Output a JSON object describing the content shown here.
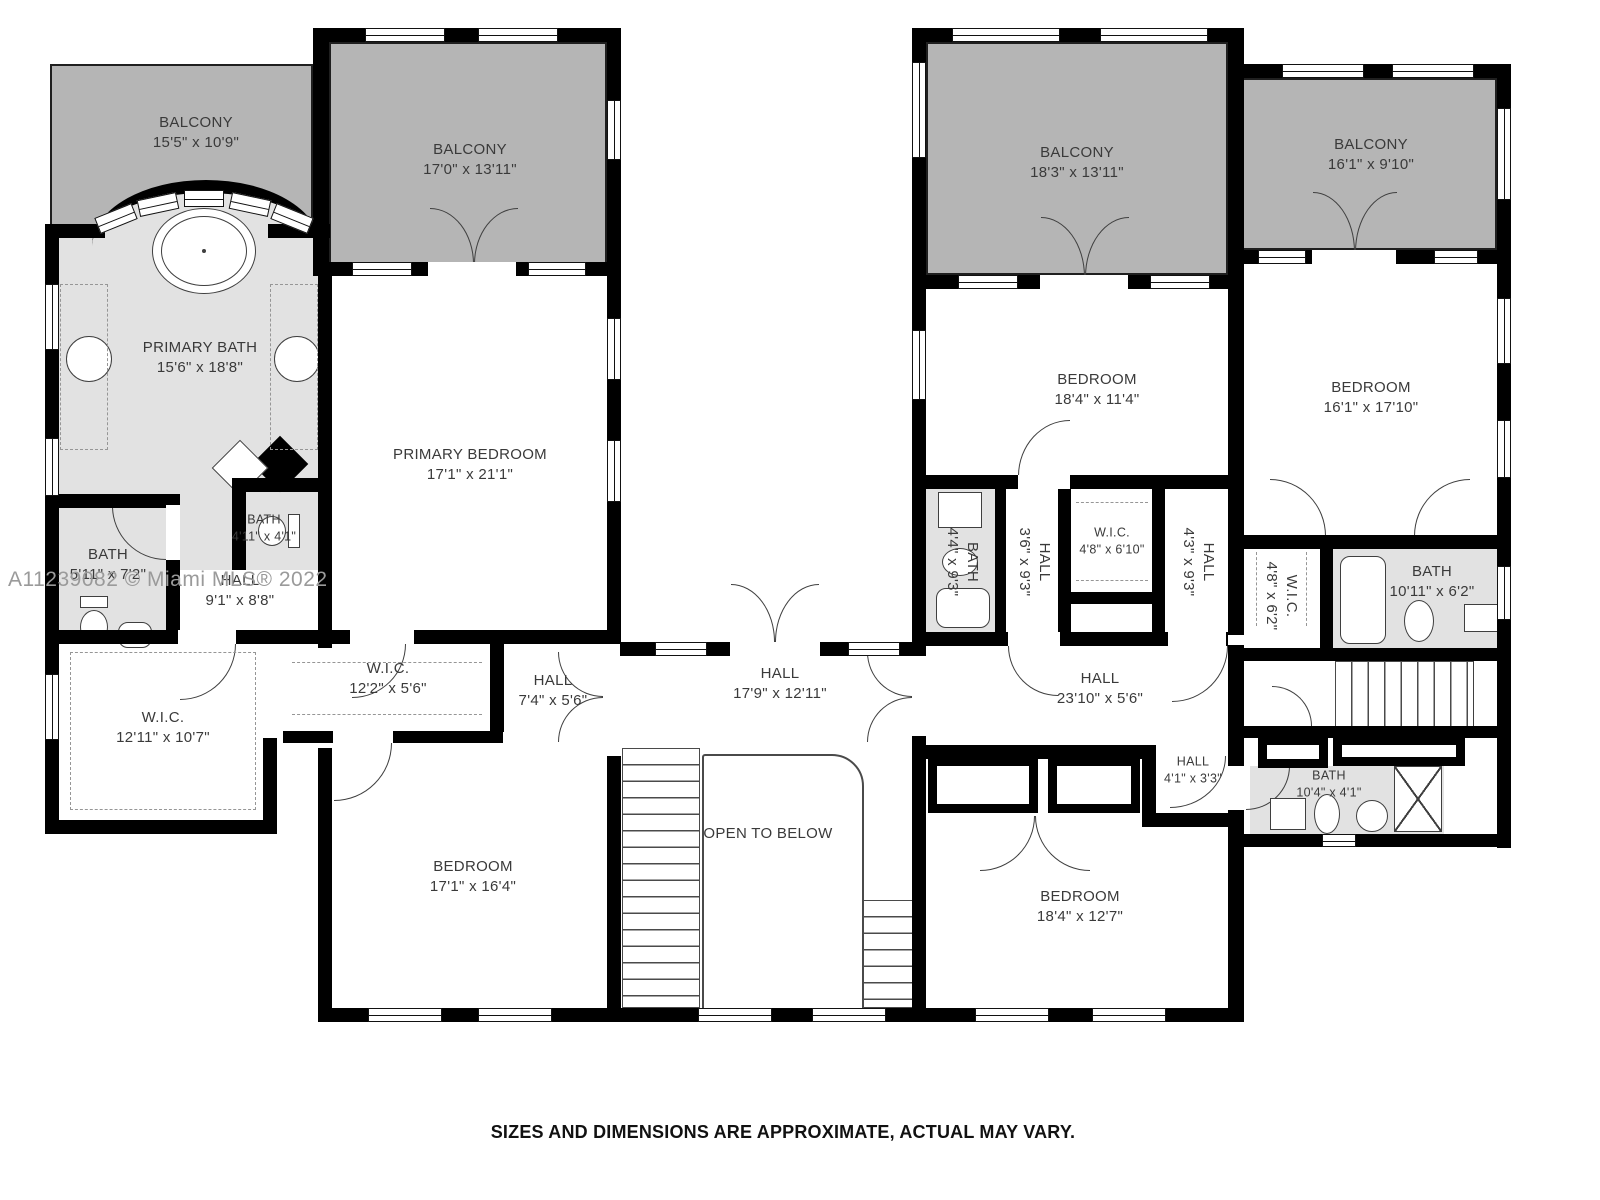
{
  "watermark": {
    "text": "A11239082 © Miami MLS® 2022"
  },
  "footer": {
    "text": "SIZES AND DIMENSIONS ARE APPROXIMATE, ACTUAL MAY VARY."
  },
  "colors": {
    "wall": "#000000",
    "balcony_fill": "#b5b5b5",
    "bath_fill": "#e2e2e2",
    "room_fill": "#ffffff",
    "label_text": "#3a3a3a",
    "watermark_text": "#9a9a9a",
    "line": "#3f3f3f"
  },
  "rooms": [
    {
      "id": "balcony-top-left",
      "name": "BALCONY",
      "dims": "15'5\" x 10'9\"",
      "x": 50,
      "y": 64,
      "w": 263,
      "h": 218,
      "fill": "balcony",
      "lx": 196,
      "ly": 133
    },
    {
      "id": "balcony-top-mid",
      "name": "BALCONY",
      "dims": "17'0\" x 13'11\"",
      "x": 329,
      "y": 42,
      "w": 278,
      "h": 222,
      "fill": "balcony",
      "lx": 470,
      "ly": 160
    },
    {
      "id": "primary-bath",
      "name": "PRIMARY BATH",
      "dims": "15'6\" x 18'8\"",
      "x": 58,
      "y": 228,
      "w": 262,
      "h": 404,
      "fill": "bath",
      "lx": 200,
      "ly": 358
    },
    {
      "id": "primary-bedroom",
      "name": "PRIMARY BEDROOM",
      "dims": "17'1\" x 21'1\"",
      "x": 332,
      "y": 276,
      "w": 275,
      "h": 356,
      "fill": "white",
      "lx": 470,
      "ly": 465
    },
    {
      "id": "bath-4-11",
      "name": "BATH",
      "dims": "4'11\" x 4'1\"",
      "x": 238,
      "y": 492,
      "w": 80,
      "h": 76,
      "fill": "bath",
      "lx": 264,
      "ly": 528,
      "small": true
    },
    {
      "id": "bath-5-11",
      "name": "BATH",
      "dims": "5'11\" x 7'2\"",
      "x": 59,
      "y": 508,
      "w": 107,
      "h": 122,
      "fill": "bath",
      "lx": 108,
      "ly": 565
    },
    {
      "id": "hall-9-1",
      "name": "HALL",
      "dims": "9'1\" x 8'8\"",
      "x": 180,
      "y": 570,
      "w": 138,
      "h": 60,
      "fill": "white",
      "lx": 240,
      "ly": 591
    },
    {
      "id": "wic-12-11",
      "name": "W.I.C.",
      "dims": "12'11\" x 10'7\"",
      "x": 59,
      "y": 644,
      "w": 204,
      "h": 176,
      "fill": "white",
      "lx": 163,
      "ly": 728
    },
    {
      "id": "wic-12-2",
      "name": "W.I.C.",
      "dims": "12'2\" x 5'6\"",
      "x": 283,
      "y": 644,
      "w": 207,
      "h": 87,
      "fill": "white",
      "lx": 388,
      "ly": 679
    },
    {
      "id": "hall-7-4",
      "name": "HALL",
      "dims": "7'4\" x 5'6\"",
      "x": 504,
      "y": 644,
      "w": 103,
      "h": 100,
      "fill": "white",
      "lx": 553,
      "ly": 691
    },
    {
      "id": "bedroom-sw",
      "name": "BEDROOM",
      "dims": "17'1\" x 16'4\"",
      "x": 332,
      "y": 748,
      "w": 275,
      "h": 260,
      "fill": "white",
      "lx": 473,
      "ly": 877
    },
    {
      "id": "hall-center",
      "name": "HALL",
      "dims": "17'9\" x 12'11\"",
      "x": 620,
      "y": 656,
      "w": 292,
      "h": 89,
      "fill": "white",
      "lx": 780,
      "ly": 684
    },
    {
      "id": "open-to-below",
      "name": "OPEN TO BELOW",
      "dims": null,
      "lx": 768,
      "ly": 834
    },
    {
      "id": "balcony-top-right",
      "name": "BALCONY",
      "dims": "18'3\" x 13'11\"",
      "x": 926,
      "y": 42,
      "w": 302,
      "h": 233,
      "fill": "balcony",
      "lx": 1077,
      "ly": 163
    },
    {
      "id": "balcony-far-right",
      "name": "BALCONY",
      "dims": "16'1\" x 9'10\"",
      "x": 1242,
      "y": 78,
      "w": 255,
      "h": 172,
      "fill": "balcony",
      "lx": 1371,
      "ly": 155
    },
    {
      "id": "bedroom-ne",
      "name": "BEDROOM",
      "dims": "18'4\" x 11'4\"",
      "x": 926,
      "y": 289,
      "w": 302,
      "h": 186,
      "fill": "white",
      "lx": 1097,
      "ly": 390
    },
    {
      "id": "bedroom-east",
      "name": "BEDROOM",
      "dims": "16'1\" x 17'10\"",
      "x": 1242,
      "y": 264,
      "w": 255,
      "h": 271,
      "fill": "white",
      "lx": 1371,
      "ly": 398
    },
    {
      "id": "bath-4-4",
      "name": "BATH",
      "dims": "4'4\" x 9'3\"",
      "x": 926,
      "y": 489,
      "w": 69,
      "h": 143,
      "fill": "bath",
      "lx": 962,
      "ly": 562,
      "vert": true
    },
    {
      "id": "hall-3-6",
      "name": "HALL",
      "dims": "3'6\" x 9'3\"",
      "x": 1006,
      "y": 489,
      "w": 52,
      "h": 143,
      "fill": "white",
      "lx": 1034,
      "ly": 562,
      "vert": true
    },
    {
      "id": "wic-4-8-6-10",
      "name": "W.I.C.",
      "dims": "4'8\" x 6'10\"",
      "x": 1071,
      "y": 489,
      "w": 81,
      "h": 103,
      "fill": "white",
      "lx": 1112,
      "ly": 541,
      "small": true
    },
    {
      "id": "hall-4-3",
      "name": "HALL",
      "dims": "4'3\" x 9'3\"",
      "x": 1165,
      "y": 489,
      "w": 63,
      "h": 143,
      "fill": "white",
      "lx": 1198,
      "ly": 562,
      "vert": true
    },
    {
      "id": "wic-4-8-6-2",
      "name": "W.I.C.",
      "dims": "4'8\" x 6'2\"",
      "x": 1242,
      "y": 549,
      "w": 78,
      "h": 99,
      "fill": "white",
      "lx": 1281,
      "ly": 596,
      "vert": true
    },
    {
      "id": "bath-10-11",
      "name": "BATH",
      "dims": "10'11\" x 6'2\"",
      "x": 1333,
      "y": 549,
      "w": 164,
      "h": 99,
      "fill": "bath",
      "lx": 1432,
      "ly": 582
    },
    {
      "id": "hall-east",
      "name": "HALL",
      "dims": "23'10\" x 5'6\"",
      "x": 926,
      "y": 646,
      "w": 302,
      "h": 99,
      "fill": "white",
      "lx": 1100,
      "ly": 689
    },
    {
      "id": "hall-4-1",
      "name": "HALL",
      "dims": "4'1\" x 3'3\"",
      "x": 1165,
      "y": 759,
      "w": 63,
      "h": 54,
      "fill": "white",
      "lx": 1193,
      "ly": 770,
      "small": true
    },
    {
      "id": "bath-10-4",
      "name": "BATH",
      "dims": "10'4\" x 4'1\"",
      "x": 1250,
      "y": 766,
      "w": 194,
      "h": 68,
      "fill": "bath",
      "lx": 1329,
      "ly": 784,
      "small": true
    },
    {
      "id": "bedroom-se",
      "name": "BEDROOM",
      "dims": "18'4\" x 12'7\"",
      "x": 926,
      "y": 759,
      "w": 302,
      "h": 249,
      "fill": "white",
      "lx": 1080,
      "ly": 907
    }
  ],
  "walls": [
    [
      313,
      28,
      16,
      248
    ],
    [
      329,
      28,
      281,
      14
    ],
    [
      607,
      28,
      14,
      614
    ],
    [
      607,
      756,
      14,
      266
    ],
    [
      45,
      224,
      14,
      610
    ],
    [
      45,
      224,
      60,
      14
    ],
    [
      268,
      224,
      62,
      14
    ],
    [
      45,
      630,
      575,
      14
    ],
    [
      318,
      262,
      14,
      386
    ],
    [
      330,
      262,
      280,
      14
    ],
    [
      232,
      478,
      14,
      92
    ],
    [
      232,
      478,
      100,
      14
    ],
    [
      45,
      494,
      135,
      14
    ],
    [
      166,
      494,
      14,
      150
    ],
    [
      45,
      820,
      232,
      14
    ],
    [
      263,
      738,
      14,
      96
    ],
    [
      283,
      731,
      220,
      12
    ],
    [
      490,
      644,
      14,
      88
    ],
    [
      318,
      748,
      14,
      274
    ],
    [
      318,
      1008,
      303,
      14
    ],
    [
      620,
      642,
      292,
      14
    ],
    [
      620,
      1008,
      300,
      14
    ],
    [
      912,
      28,
      330,
      14
    ],
    [
      912,
      28,
      14,
      250
    ],
    [
      1228,
      28,
      16,
      237
    ],
    [
      1242,
      64,
      268,
      14
    ],
    [
      1497,
      64,
      14,
      784
    ],
    [
      912,
      275,
      332,
      14
    ],
    [
      912,
      275,
      14,
      381
    ],
    [
      912,
      736,
      14,
      286
    ],
    [
      1242,
      250,
      255,
      14
    ],
    [
      1228,
      263,
      16,
      225
    ],
    [
      912,
      475,
      332,
      14
    ],
    [
      995,
      489,
      11,
      143
    ],
    [
      1058,
      480,
      13,
      152
    ],
    [
      1152,
      480,
      13,
      152
    ],
    [
      1064,
      592,
      101,
      12
    ],
    [
      1228,
      475,
      16,
      160
    ],
    [
      1242,
      535,
      255,
      14
    ],
    [
      1320,
      549,
      13,
      99
    ],
    [
      926,
      632,
      302,
      14
    ],
    [
      1242,
      648,
      268,
      13
    ],
    [
      912,
      745,
      232,
      14
    ],
    [
      1142,
      745,
      14,
      82
    ],
    [
      1156,
      813,
      86,
      14
    ],
    [
      1228,
      645,
      16,
      377
    ],
    [
      1242,
      726,
      268,
      12
    ],
    [
      1242,
      834,
      268,
      13
    ],
    [
      912,
      1008,
      330,
      14
    ]
  ],
  "windows": [
    [
      365,
      28,
      80,
      14
    ],
    [
      478,
      28,
      80,
      14
    ],
    [
      607,
      100,
      14,
      60
    ],
    [
      607,
      318,
      14,
      62
    ],
    [
      607,
      440,
      14,
      62
    ],
    [
      45,
      284,
      14,
      66
    ],
    [
      45,
      438,
      14,
      58
    ],
    [
      45,
      674,
      14,
      66
    ],
    [
      352,
      262,
      60,
      14
    ],
    [
      528,
      262,
      58,
      14
    ],
    [
      368,
      1008,
      74,
      14
    ],
    [
      478,
      1008,
      74,
      14
    ],
    [
      698,
      1008,
      74,
      14
    ],
    [
      812,
      1008,
      74,
      14
    ],
    [
      655,
      642,
      52,
      14
    ],
    [
      848,
      642,
      52,
      14
    ],
    [
      952,
      28,
      108,
      14
    ],
    [
      1100,
      28,
      108,
      14
    ],
    [
      912,
      62,
      14,
      96
    ],
    [
      1282,
      64,
      82,
      14
    ],
    [
      1392,
      64,
      82,
      14
    ],
    [
      1497,
      108,
      14,
      92
    ],
    [
      1497,
      298,
      14,
      66
    ],
    [
      1497,
      420,
      14,
      58
    ],
    [
      1497,
      566,
      14,
      54
    ],
    [
      958,
      275,
      60,
      14
    ],
    [
      1150,
      275,
      60,
      14
    ],
    [
      912,
      330,
      14,
      70
    ],
    [
      1258,
      250,
      48,
      14
    ],
    [
      1434,
      250,
      44,
      14
    ],
    [
      975,
      1008,
      74,
      14
    ],
    [
      1092,
      1008,
      74,
      14
    ],
    [
      1322,
      834,
      34,
      13
    ]
  ],
  "door_gaps": [
    [
      428,
      262,
      88,
      14
    ],
    [
      730,
      642,
      90,
      14
    ],
    [
      1040,
      275,
      88,
      14
    ],
    [
      1312,
      250,
      84,
      14
    ],
    [
      1008,
      632,
      52,
      14
    ],
    [
      1168,
      632,
      58,
      14
    ],
    [
      1018,
      475,
      52,
      14
    ],
    [
      178,
      630,
      58,
      14
    ],
    [
      350,
      630,
      64,
      14
    ],
    [
      333,
      731,
      60,
      12
    ],
    [
      166,
      505,
      14,
      55
    ],
    [
      1228,
      766,
      16,
      44
    ]
  ],
  "doors": [
    [
      430,
      208,
      44,
      56,
      "tr"
    ],
    [
      474,
      208,
      44,
      56,
      "tl"
    ],
    [
      731,
      584,
      44,
      58,
      "tr"
    ],
    [
      775,
      584,
      44,
      58,
      "tl"
    ],
    [
      1041,
      217,
      44,
      60,
      "tr"
    ],
    [
      1085,
      217,
      44,
      60,
      "tl"
    ],
    [
      1313,
      192,
      42,
      60,
      "tr"
    ],
    [
      1355,
      192,
      42,
      60,
      "tl"
    ],
    [
      867,
      652,
      45,
      45,
      "bl"
    ],
    [
      867,
      697,
      45,
      45,
      "tl"
    ],
    [
      558,
      652,
      45,
      45,
      "bl"
    ],
    [
      558,
      697,
      45,
      45,
      "tl"
    ],
    [
      980,
      816,
      55,
      55,
      "br"
    ],
    [
      1035,
      816,
      55,
      55,
      "bl"
    ],
    [
      180,
      644,
      56,
      56,
      "br"
    ],
    [
      334,
      743,
      58,
      58,
      "br"
    ],
    [
      352,
      644,
      54,
      54,
      "br"
    ],
    [
      1008,
      646,
      50,
      50,
      "bl"
    ],
    [
      1172,
      646,
      56,
      56,
      "br"
    ],
    [
      1270,
      479,
      56,
      57,
      "tr"
    ],
    [
      1414,
      479,
      56,
      57,
      "tl"
    ],
    [
      1246,
      766,
      44,
      44,
      "br"
    ],
    [
      1170,
      756,
      56,
      52,
      "br"
    ],
    [
      112,
      506,
      54,
      54,
      "bl"
    ],
    [
      1018,
      420,
      52,
      56,
      "tl"
    ],
    [
      1272,
      686,
      40,
      40,
      "tr"
    ]
  ],
  "stairs": [
    {
      "x": 622,
      "y": 748,
      "w": 78,
      "h": 260,
      "dir": "h"
    },
    {
      "x": 862,
      "y": 900,
      "w": 55,
      "h": 108,
      "dir": "h"
    },
    {
      "x": 1335,
      "y": 661,
      "w": 140,
      "h": 66,
      "dir": "v"
    }
  ],
  "arch": {
    "x": 92,
    "y": 180,
    "w": 228,
    "h": 66
  },
  "arch_windows": [
    {
      "x": 96,
      "y": 210,
      "r": -22
    },
    {
      "x": 138,
      "y": 196,
      "r": -12
    },
    {
      "x": 184,
      "y": 190,
      "r": 0
    },
    {
      "x": 230,
      "y": 196,
      "r": 12
    },
    {
      "x": 272,
      "y": 210,
      "r": 22
    }
  ],
  "open_below_outline": {
    "x": 702,
    "y": 754,
    "w": 162,
    "h": 262
  },
  "closets": [
    [
      928,
      757,
      110,
      56
    ],
    [
      1048,
      757,
      92,
      56
    ],
    [
      1258,
      736,
      70,
      32
    ],
    [
      1333,
      736,
      132,
      30
    ]
  ],
  "fixtures": [
    {
      "t": "ellipse",
      "x": 152,
      "y": 208,
      "w": 104,
      "h": 86
    },
    {
      "t": "ellipse",
      "x": 161,
      "y": 216,
      "w": 86,
      "h": 70,
      "thin": true
    },
    {
      "t": "dot",
      "x": 202,
      "y": 249
    },
    {
      "t": "circle",
      "x": 66,
      "y": 336,
      "w": 46
    },
    {
      "t": "circle",
      "x": 274,
      "y": 336,
      "w": 46
    },
    {
      "t": "rect",
      "x": 80,
      "y": 596,
      "w": 28,
      "h": 12
    },
    {
      "t": "ellipse",
      "x": 80,
      "y": 610,
      "w": 28,
      "h": 34
    },
    {
      "t": "rrect",
      "x": 118,
      "y": 622,
      "w": 34,
      "h": 26
    },
    {
      "t": "rect",
      "x": 288,
      "y": 514,
      "w": 12,
      "h": 34
    },
    {
      "t": "ellipse",
      "x": 258,
      "y": 516,
      "w": 28,
      "h": 30
    },
    {
      "t": "rect",
      "x": 938,
      "y": 492,
      "w": 44,
      "h": 36
    },
    {
      "t": "ellipse",
      "x": 942,
      "y": 548,
      "w": 36,
      "h": 28
    },
    {
      "t": "rrect",
      "x": 936,
      "y": 588,
      "w": 54,
      "h": 40
    },
    {
      "t": "rrect",
      "x": 1340,
      "y": 556,
      "w": 46,
      "h": 88
    },
    {
      "t": "ellipse",
      "x": 1404,
      "y": 600,
      "w": 30,
      "h": 42
    },
    {
      "t": "rect",
      "x": 1464,
      "y": 604,
      "w": 34,
      "h": 28
    },
    {
      "t": "rect",
      "x": 1270,
      "y": 798,
      "w": 36,
      "h": 32
    },
    {
      "t": "ellipse",
      "x": 1314,
      "y": 794,
      "w": 26,
      "h": 40
    },
    {
      "t": "circle",
      "x": 1356,
      "y": 800,
      "w": 32
    },
    {
      "t": "xbox",
      "x": 1394,
      "y": 766,
      "w": 48,
      "h": 66
    },
    {
      "t": "diamondfill",
      "x": 260,
      "y": 444,
      "w": 40,
      "h": 40
    },
    {
      "t": "diamond",
      "x": 220,
      "y": 448,
      "w": 40,
      "h": 40
    },
    {
      "t": "rect",
      "x": 1473,
      "y": 650,
      "w": 34,
      "h": 88
    }
  ],
  "dashes": [
    {
      "t": "rect",
      "x": 70,
      "y": 652,
      "w": 186,
      "h": 158
    },
    {
      "t": "rect",
      "x": 60,
      "y": 284,
      "w": 48,
      "h": 166
    },
    {
      "t": "rect",
      "x": 270,
      "y": 284,
      "w": 48,
      "h": 166
    },
    {
      "t": "h",
      "x": 292,
      "y": 662,
      "w": 190
    },
    {
      "t": "h",
      "x": 292,
      "y": 714,
      "w": 190
    },
    {
      "t": "h",
      "x": 1076,
      "y": 502,
      "w": 72
    },
    {
      "t": "h",
      "x": 1076,
      "y": 580,
      "w": 72
    },
    {
      "t": "v",
      "x": 1256,
      "y": 552,
      "h": 74
    },
    {
      "t": "v",
      "x": 1306,
      "y": 552,
      "h": 74
    }
  ]
}
